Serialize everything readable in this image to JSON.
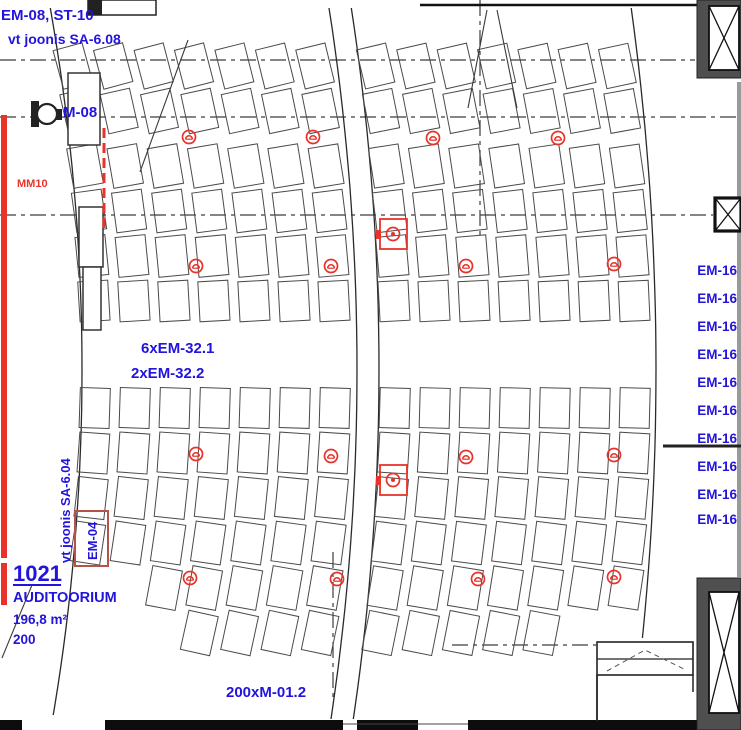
{
  "title": "Auditorium electrical floor plan (CAD view)",
  "colors": {
    "blue_label": "#2213dd",
    "red_symbol": "#e8332a",
    "seat_line": "#4a4a4a",
    "wall_dark": "#111111",
    "frame_gray": "#4f4f4f",
    "grid_line": "#3c3c3c"
  },
  "labels": [
    {
      "id": "ref-em08-st10",
      "text": "EM-08, ST-10",
      "x": 1,
      "y": 20,
      "size": 15,
      "color": "blue",
      "weight": "bold"
    },
    {
      "id": "ref-vt-joonis-sa-608",
      "text": "vt joonis SA-6.08",
      "x": 8,
      "y": 44,
      "size": 14,
      "color": "blue",
      "weight": "bold"
    },
    {
      "id": "device-m08",
      "text": "M-08",
      "x": 63,
      "y": 117,
      "size": 15,
      "color": "blue",
      "weight": "bold"
    },
    {
      "id": "ref-mm10",
      "text": "MM10",
      "x": 17,
      "y": 187,
      "size": 11,
      "color": "red",
      "weight": "bold"
    },
    {
      "id": "ref-6xem-321",
      "text": "6xEM-32.1",
      "x": 141,
      "y": 353,
      "size": 15,
      "color": "blue",
      "weight": "bold"
    },
    {
      "id": "ref-2xem-322",
      "text": "2xEM-32.2",
      "x": 131,
      "y": 378,
      "size": 15,
      "color": "blue",
      "weight": "bold"
    },
    {
      "id": "ref-em16-1",
      "text": "EM-16",
      "x": 737,
      "y": 275,
      "size": 13.5,
      "color": "blue",
      "weight": "bold",
      "anchor": "end"
    },
    {
      "id": "ref-em16-2",
      "text": "EM-16",
      "x": 737,
      "y": 303,
      "size": 13.5,
      "color": "blue",
      "weight": "bold",
      "anchor": "end"
    },
    {
      "id": "ref-em16-3",
      "text": "EM-16",
      "x": 737,
      "y": 331,
      "size": 13.5,
      "color": "blue",
      "weight": "bold",
      "anchor": "end"
    },
    {
      "id": "ref-em16-4",
      "text": "EM-16",
      "x": 737,
      "y": 359,
      "size": 13.5,
      "color": "blue",
      "weight": "bold",
      "anchor": "end"
    },
    {
      "id": "ref-em16-5",
      "text": "EM-16",
      "x": 737,
      "y": 387,
      "size": 13.5,
      "color": "blue",
      "weight": "bold",
      "anchor": "end"
    },
    {
      "id": "ref-em16-6",
      "text": "EM-16",
      "x": 737,
      "y": 415,
      "size": 13.5,
      "color": "blue",
      "weight": "bold",
      "anchor": "end"
    },
    {
      "id": "ref-em16-7",
      "text": "EM-16",
      "x": 737,
      "y": 443,
      "size": 13.5,
      "color": "blue",
      "weight": "bold",
      "anchor": "end"
    },
    {
      "id": "ref-em16-8",
      "text": "EM-16",
      "x": 737,
      "y": 471,
      "size": 13.5,
      "color": "blue",
      "weight": "bold",
      "anchor": "end"
    },
    {
      "id": "ref-em16-9",
      "text": "EM-16",
      "x": 737,
      "y": 499,
      "size": 13.5,
      "color": "blue",
      "weight": "bold",
      "anchor": "end"
    },
    {
      "id": "ref-em16-10",
      "text": "EM-16",
      "x": 737,
      "y": 524,
      "size": 13.5,
      "color": "blue",
      "weight": "bold",
      "anchor": "end"
    },
    {
      "id": "ref-vt-joonis-sa-604",
      "text": "vt joonis SA-6.04",
      "x": 70,
      "y": 563,
      "size": 13,
      "color": "blue",
      "weight": "bold",
      "rotate": -90
    },
    {
      "id": "device-em04",
      "text": "EM-04",
      "x": 97,
      "y": 560,
      "size": 13,
      "color": "blue",
      "weight": "bold",
      "rotate": -90
    },
    {
      "id": "room-number",
      "text": "1021",
      "x": 13,
      "y": 581,
      "size": 22,
      "color": "blue",
      "weight": "bold",
      "underline": true
    },
    {
      "id": "room-name",
      "text": "AUDITOORIUM",
      "x": 13,
      "y": 602,
      "size": 14.5,
      "color": "blue",
      "weight": "bold"
    },
    {
      "id": "room-area",
      "text": "196,8 m²",
      "x": 13,
      "y": 624,
      "size": 13.5,
      "color": "blue",
      "weight": "bold"
    },
    {
      "id": "room-capacity",
      "text": "200",
      "x": 13,
      "y": 644,
      "size": 13.5,
      "color": "blue",
      "weight": "bold"
    },
    {
      "id": "ref-200xm-012",
      "text": "200xM-01.2",
      "x": 226,
      "y": 697,
      "size": 15,
      "color": "blue",
      "weight": "bold"
    }
  ],
  "seating": {
    "arc_center_x": -2000,
    "arc_center_y": 370,
    "tilt_factor": 0.55,
    "seat_w": 30,
    "seat_h": 40,
    "arc_x_mids": [
      95,
      135,
      175,
      215,
      255,
      295,
      335,
      395,
      435,
      475,
      515,
      555,
      595,
      635
    ],
    "blocks": [
      {
        "name": "upper",
        "row_tops": [
          46,
          91,
          146,
          191,
          236,
          281
        ],
        "skip": {}
      },
      {
        "name": "lower",
        "row_tops": [
          388,
          433,
          478,
          523,
          568,
          613
        ],
        "skip": {
          "0": [
            4,
            5
          ],
          "1": [
            4,
            5
          ],
          "2": [
            5
          ],
          "12": [
            5
          ],
          "13": [
            5
          ]
        }
      }
    ]
  },
  "aisle_curves": [
    {
      "x_mid": 82,
      "y0": 8,
      "y1": 715
    },
    {
      "x_mid": 357,
      "y0": 8,
      "y1": 719
    },
    {
      "x_mid": 379,
      "y0": 8,
      "y1": 719
    },
    {
      "x_mid": 656,
      "y0": 8,
      "y1": 638
    }
  ],
  "grid_lines": {
    "horizontal": [
      {
        "y": 60,
        "x0": 0,
        "x1": 695
      },
      {
        "y": 117,
        "x0": 0,
        "x1": 740
      },
      {
        "y": 215,
        "x0": 0,
        "x1": 713
      },
      {
        "y": 645,
        "x0": 452,
        "x1": 596
      }
    ],
    "vertical": [
      {
        "x": 480,
        "y0": 0,
        "y1": 237
      },
      {
        "x": 333,
        "y0": 552,
        "y1": 700
      }
    ]
  },
  "outlet_circles": [
    {
      "x": 189,
      "y": 137
    },
    {
      "x": 313,
      "y": 137
    },
    {
      "x": 433,
      "y": 138
    },
    {
      "x": 558,
      "y": 138
    },
    {
      "x": 196,
      "y": 266
    },
    {
      "x": 331,
      "y": 266
    },
    {
      "x": 466,
      "y": 266
    },
    {
      "x": 614,
      "y": 264
    },
    {
      "x": 196,
      "y": 454
    },
    {
      "x": 331,
      "y": 456
    },
    {
      "x": 466,
      "y": 457
    },
    {
      "x": 614,
      "y": 455
    },
    {
      "x": 190,
      "y": 578
    },
    {
      "x": 337,
      "y": 579
    },
    {
      "x": 478,
      "y": 579
    },
    {
      "x": 614,
      "y": 577
    }
  ],
  "floor_boxes": [
    {
      "x": 393,
      "y": 234
    },
    {
      "x": 393,
      "y": 480
    }
  ],
  "columns": {
    "top_right": {
      "outer": [
        697,
        0,
        44,
        78
      ],
      "inner": [
        709,
        6,
        30,
        64
      ]
    },
    "mid_right": {
      "box": [
        715,
        198,
        26,
        33
      ]
    },
    "bottom_right": {
      "outer": [
        697,
        578,
        44,
        152
      ],
      "inner": [
        709,
        592,
        30,
        121
      ]
    }
  },
  "room_niche": {
    "rect": [
      597,
      642,
      96,
      33
    ],
    "divider_y": 659,
    "chevron": [
      [
        607,
        671
      ],
      [
        645,
        650
      ],
      [
        686,
        670
      ]
    ],
    "wall_left": [
      597,
      675,
      597,
      721
    ],
    "wall_right": [
      693,
      675,
      693,
      692
    ]
  },
  "walls": {
    "top_line": [
      420,
      5,
      697,
      5
    ],
    "right_mid_line": [
      663,
      446,
      741,
      446
    ],
    "bottom_segments": [
      [
        0,
        22
      ],
      [
        105,
        343
      ],
      [
        357,
        418
      ],
      [
        468,
        697
      ]
    ],
    "bottom_gap_line": [
      343,
      724,
      468,
      724
    ],
    "right_gray_strip": [
      737,
      82,
      4,
      495
    ]
  },
  "piers": [
    [
      68,
      73,
      32,
      72
    ],
    [
      79,
      207,
      24,
      60
    ],
    [
      83,
      267,
      18,
      63
    ]
  ],
  "top_left_fragment": {
    "outline": [
      88,
      0,
      68,
      15
    ],
    "solid": [
      88,
      0,
      14,
      15
    ]
  },
  "m08_device": {
    "body": [
      31,
      101,
      8,
      26
    ],
    "circle": [
      47,
      114,
      10
    ],
    "stub": [
      56,
      109,
      6,
      11
    ]
  },
  "red_wall_bars": [
    [
      1,
      115,
      6,
      443
    ],
    [
      1,
      563,
      6,
      42
    ]
  ],
  "red_dashed_line": {
    "x": 104,
    "y0": 128,
    "y1": 232
  },
  "em04_box": [
    75,
    511,
    33,
    55
  ],
  "diagonals": [
    [
      140,
      172,
      188,
      40
    ],
    [
      2,
      658,
      32,
      585
    ],
    [
      487,
      10,
      468,
      108
    ],
    [
      497,
      10,
      517,
      108
    ]
  ]
}
